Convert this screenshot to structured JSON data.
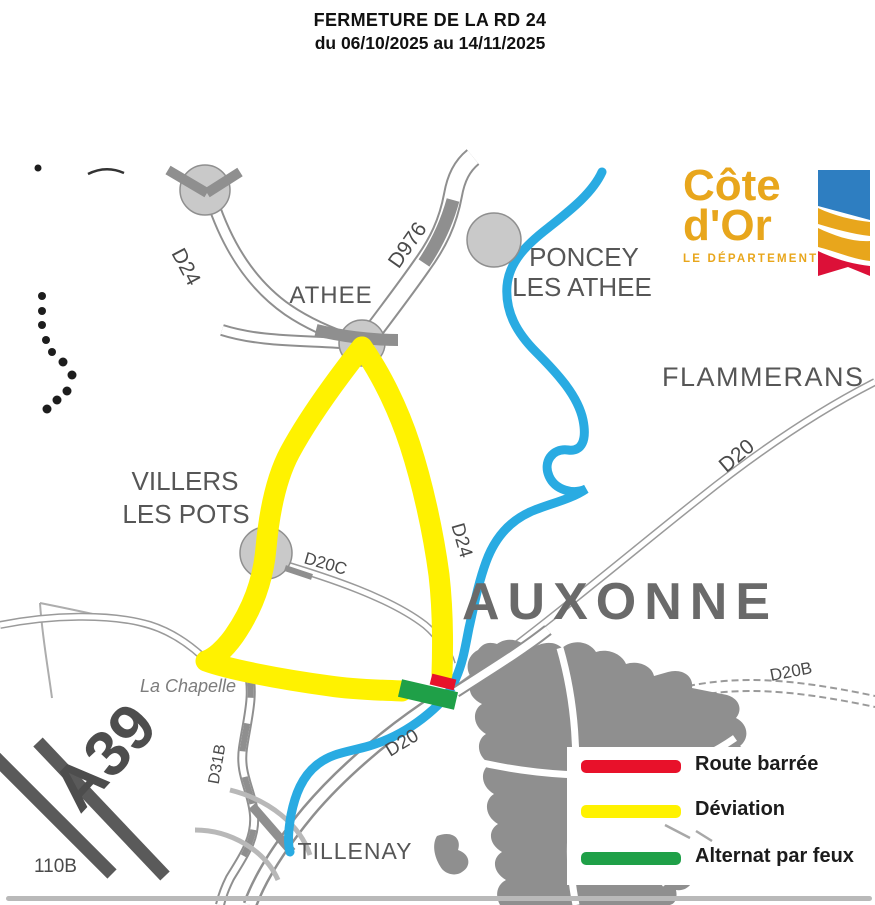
{
  "title": {
    "line1": "FERMETURE DE LA RD 24",
    "line2": "du 06/10/2025 au 14/11/2025"
  },
  "logo": {
    "line1": "Côte",
    "line2": "d'Or",
    "subtitle": "LE DÉPARTEMENT"
  },
  "map": {
    "towns": {
      "athee": "ATHEE",
      "poncey_line1": "PONCEY",
      "poncey_line2": "LES ATHEE",
      "flammerans": "FLAMMERANS",
      "villers_line1": "VILLERS",
      "villers_line2": "LES POTS",
      "auxonne": "AUXONNE",
      "la_chapelle": "La Chapelle",
      "tillenay": "TILLENAY"
    },
    "roads": {
      "d24_north": "D24",
      "d976": "D976",
      "d24_south": "D24",
      "d20_northeast": "D20",
      "d20c": "D20C",
      "d20b": "D20B",
      "d20_south": "D20",
      "d31b": "D31B",
      "a39": "A39",
      "road_110b": "110B"
    }
  },
  "legend": {
    "items": [
      {
        "label": "Route barrée",
        "color": "#E8112A"
      },
      {
        "label": "Déviation",
        "color": "#FFF200"
      },
      {
        "label": "Alternat par feux",
        "color": "#1FA048"
      }
    ]
  },
  "colors": {
    "river": "#29ABE2",
    "deviation": "#FFF200",
    "closure": "#E8112A",
    "alternating": "#1FA048",
    "urban": "#8F8F8F",
    "logo_gold": "#E8A61C",
    "logo_blue": "#2E7EC1",
    "logo_red": "#DC1038"
  }
}
